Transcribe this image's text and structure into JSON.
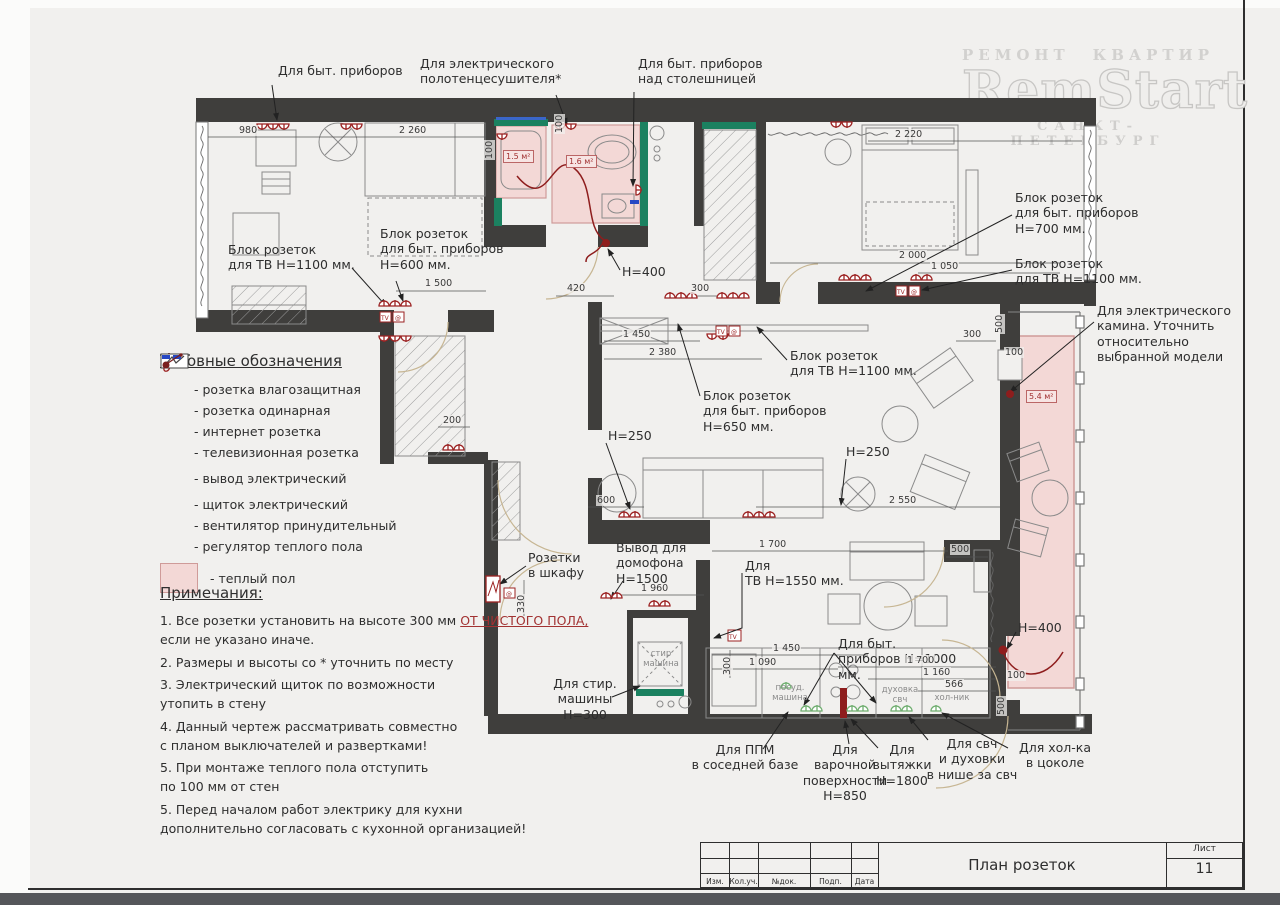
{
  "logo": {
    "word1": "РЕМОНТ",
    "word2": "КВАРТИР",
    "name": "RemStart",
    "city": "САНКТ-ПЕТЕРБУРГ"
  },
  "icons": {
    "tv": "TV",
    "at": "@"
  },
  "legend": {
    "title": "Условные обозначения",
    "items": [
      {
        "icon": "socket-waterproof-icon",
        "label": "- розетка влагозащитная"
      },
      {
        "icon": "socket-single-icon",
        "label": "- розетка одинарная"
      },
      {
        "icon": "internet-socket-icon",
        "label": "- интернет розетка"
      },
      {
        "icon": "tv-socket-icon",
        "label": "- телевизионная розетка"
      },
      {
        "icon": "electric-outlet-icon",
        "label": "- вывод электрический"
      },
      {
        "icon": "electric-panel-icon",
        "label": "- щиток электрический"
      },
      {
        "icon": "fan-icon",
        "label": "- вентилятор принудительный"
      },
      {
        "icon": "floor-heating-regulator-icon",
        "label": "- регулятор теплого пола"
      },
      {
        "icon": "warm-floor-swatch",
        "label": "- теплый пол"
      }
    ]
  },
  "notes": {
    "title": "Примечания:",
    "n1a": "1. Все розетки установить на высоте 300 мм",
    "n1b": "ОТ ЧИСТОГО ПОЛА,",
    "n1c": "если не указано иначе.",
    "n2": "2. Размеры и высоты со * уточнить по месту",
    "n3": "3. Электрический щиток по возможности\nутопить  в стену",
    "n4": "4. Данный чертеж рассматривать совместно\nс планом выключателей и развертками!",
    "n5": "5. При монтаже теплого пола отступить\nпо 100 мм от стен",
    "n6": "5. Перед началом работ электрику для кухни\nдополнительно согласовать с кухонной организацией!"
  },
  "callouts": [
    "Для быт. приборов",
    "Для электрического\nполотенцесушителя*",
    "Для быт. приборов\nнад столешницей",
    "Блок розеток\nдля ТВ Н=1100 мм.",
    "Блок розеток\nдля быт. приборов\nН=600 мм.",
    "Блок розеток\nдля быт. приборов\nН=700 мм.",
    "Блок розеток\nдля ТВ Н=1100 мм.",
    "Для электрического\nкамина. Уточнить\nотносительно\nвыбранной модели",
    "Блок розеток\nдля ТВ Н=1100 мм.",
    "Блок розеток\nдля быт. приборов\nН=650 мм.",
    "Н=250",
    "Н=250",
    "Н=400",
    "Розетки\nв шкафу",
    "Вывод для\nдомофона\nН=1500",
    "Для\nТВ Н=1550 мм.",
    "Для быт.\nприборов Н=1000 мм.",
    "Для стир.\nмашины\nН=300",
    "Для ППМ\nв соседней базе",
    "Для\nварочной\nповерхности\nН=850",
    "Для\nвытяжки\nН=1800",
    "Для свч\nи духовки\nв нише за свч",
    "Для хол-ка\nв цоколе",
    "Н=400"
  ],
  "dims": [
    "980",
    "2 260",
    "2 220",
    "1 500",
    "420",
    "300",
    "2 000",
    "1 050",
    "1 450",
    "2 380",
    "300",
    "600",
    "2 550",
    "200",
    "330",
    "1 960",
    "1 700",
    "500",
    "1 450",
    "300",
    "1 090",
    "1 700",
    "1 160",
    "566",
    "100",
    "500",
    "100",
    "500",
    "100",
    "100"
  ],
  "labels": {
    "washer": "стир\nмашина",
    "dishwasher": "посуд.\nмашина",
    "oven": "духовка\nсвч",
    "fridge": "хол-ник",
    "area_bath1": "1.5 м²",
    "area_bath2": "1.6 м²",
    "area_balcony": "5.4 м²"
  },
  "title_block": {
    "title": "План розеток",
    "sheet_label": "Лист",
    "sheet_number": "11",
    "cols": [
      "Изм.",
      "Кол.уч.",
      "№док.",
      "Подп.",
      "Дата"
    ]
  }
}
